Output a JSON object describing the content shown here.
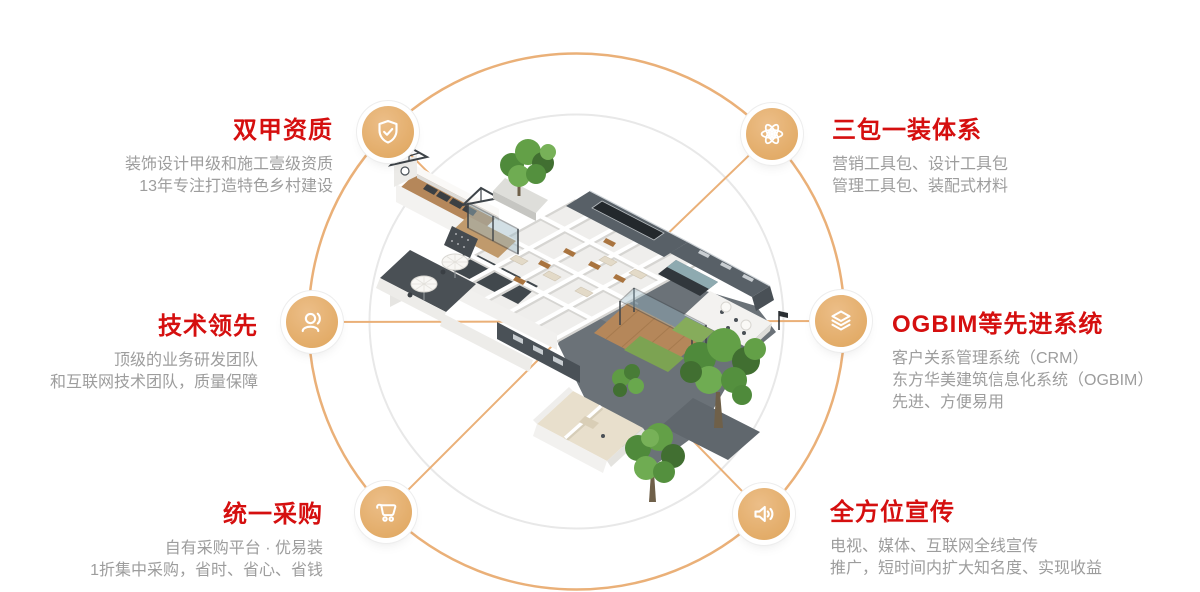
{
  "page": {
    "type": "feature-wheel-infographic",
    "background": "#ffffff"
  },
  "colors": {
    "orbit_circle_orange": "#EAB078",
    "inner_ring_gray": "#E8E8E8",
    "icon_fill": "#E2A967",
    "heading_red": "#D50F0F",
    "body_gray": "#9D9D9D"
  },
  "center": {
    "illustration": "isometric-building-cutaway",
    "description": "3D isometric cutaway floor plan of a courtyard building with guest rooms, rooftop truss terrace, umbrellas, wooden deck pavilion and green trees"
  },
  "features": [
    {
      "id": "top-left",
      "icon": "shield-check-icon",
      "title": "双甲资质",
      "lines": [
        "装饰设计甲级和施工壹级资质",
        "13年专注打造特色乡村建设"
      ]
    },
    {
      "id": "top-right",
      "icon": "atom-icon",
      "title": "三包一装体系",
      "lines": [
        "营销工具包、设计工具包",
        "管理工具包、装配式材料"
      ]
    },
    {
      "id": "middle-left",
      "icon": "user-service-icon",
      "title": "技术领先",
      "lines": [
        "顶级的业务研发团队",
        "和互联网技术团队，质量保障"
      ]
    },
    {
      "id": "middle-right",
      "icon": "layers-icon",
      "title": "OGBIM等先进系统",
      "lines": [
        "客户关系管理系统（CRM）",
        "东方华美建筑信息化系统（OGBIM）",
        "先进、方便易用"
      ]
    },
    {
      "id": "bottom-left",
      "icon": "shopping-cart-icon",
      "title": "统一采购",
      "lines": [
        "自有采购平台 · 优易装",
        "1折集中采购，省时、省心、省钱"
      ]
    },
    {
      "id": "bottom-right",
      "icon": "speaker-icon",
      "title": "全方位宣传",
      "lines": [
        "电视、媒体、互联网全线宣传",
        "推广，短时间内扩大知名度、实现收益"
      ]
    }
  ]
}
